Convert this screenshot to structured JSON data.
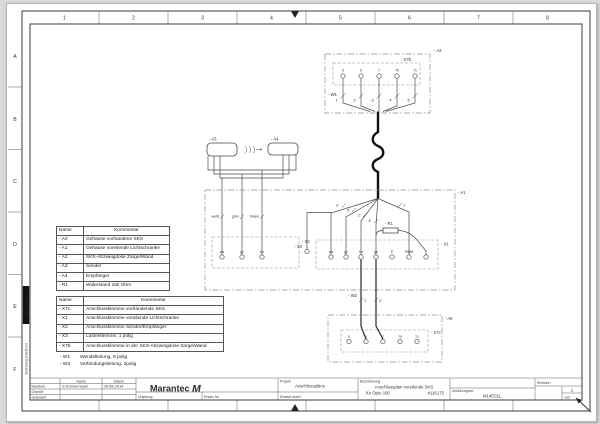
{
  "frame": {
    "columns": [
      "1",
      "2",
      "3",
      "4",
      "5",
      "6",
      "7",
      "8"
    ],
    "rows": [
      "A",
      "B",
      "C",
      "D",
      "E",
      "F"
    ],
    "side_note": "Zeichnung erstellt mit",
    "side_badge": "Engineering Base"
  },
  "components_table": {
    "headers": [
      "Name",
      "Kommentar"
    ],
    "rows": [
      {
        "name": "- A0",
        "comment": "Gehäuse vorhandene SKS"
      },
      {
        "name": "- A1",
        "comment": "Gehäuse voreilende Lichtschranke"
      },
      {
        "name": "- A2",
        "comment": "SKS-Abzweigdose Zarge/Wand"
      },
      {
        "name": "- A3",
        "comment": "Sender"
      },
      {
        "name": "- A4",
        "comment": "Empfänger"
      },
      {
        "name": "- R1",
        "comment": "Widerstand 15k Ohm"
      }
    ]
  },
  "terminals_table": {
    "headers": [
      "Name",
      "Kommentar"
    ],
    "rows": [
      {
        "name": "- X7c",
        "comment": "Anschlussklemme vorhandende SKS"
      },
      {
        "name": "- X1",
        "comment": "Anschlussklemme voreilende Lichtschranke"
      },
      {
        "name": "- X2",
        "comment": "Anschlussklemme Sender/Empfänger"
      },
      {
        "name": "- X3",
        "comment": "Lüsterklemme, 1 polig"
      },
      {
        "name": "- X7b",
        "comment": "Anschlussklemme in der SKS-Abzweigdose Zarge/Wand"
      }
    ]
  },
  "notes": [
    {
      "name": "- W1",
      "comment": "Wendelleitung, 5 polig"
    },
    {
      "name": "- W2",
      "comment": "Verbindungsleitung, 2polig"
    }
  ],
  "diagram": {
    "labels": {
      "a2": "- A2",
      "x7b": "- X7b",
      "w1": "- W1",
      "a3": "- A3",
      "a4": "- A4",
      "a1": "- A1",
      "x2": "- X2",
      "x3": "- X3",
      "x1": "- X1",
      "r1": "- R1",
      "w2": "- W2",
      "a0": "- A0",
      "x7c": "- X7c"
    },
    "x7b_terminals": [
      "5",
      "6",
      "7",
      "70",
      "71"
    ],
    "w1_wires": [
      "1'",
      "2'",
      "3'",
      "4'",
      "5'"
    ],
    "fan_wires": [
      "3'",
      "5'",
      "2'",
      "4'",
      "1'"
    ],
    "x2_wire_labels": [
      "weiß",
      "grün",
      "braun"
    ],
    "x2_terminals": [
      "ws",
      "gn",
      "bn"
    ],
    "x1_terminals": [
      "ws",
      "gn",
      "bn",
      "ge",
      "P",
      "PWM",
      ""
    ],
    "w2_wires": [
      "1'",
      "2'"
    ],
    "x7c_terminals": [
      "5",
      "6",
      "7",
      "70",
      "71"
    ]
  },
  "titleblock": {
    "name_label": "Name",
    "date_label": "Datum",
    "row1_label": "Bearbeit.",
    "row1_name": "S.Künnemeyer",
    "row1_date": "28.08.2014",
    "row2_label": "Geprüft",
    "row3_label": "Geändert",
    "brand": "Marantec",
    "brand_mark": "M",
    "ursprung_label": "Ursprung",
    "ersatz_label": "Ersatz für",
    "ersetzt_label": "Ersetzt durch",
    "projekt_label": "Projekt",
    "projekt_value": "Anschlusspläne",
    "bezeichnung_label": "Bezeichnung",
    "bezeichnung_line1": "Anschlussplan voreilende SKS",
    "bezeichnung_line2": "für Opto 180",
    "bezeichnung_number": "#116175",
    "zeichnungsnr_label": "Zeichnungsnr:",
    "zeichnungsnr_value": "M14E011",
    "revision_label": "Revision",
    "sheet_number": "1",
    "von_label": "von"
  }
}
